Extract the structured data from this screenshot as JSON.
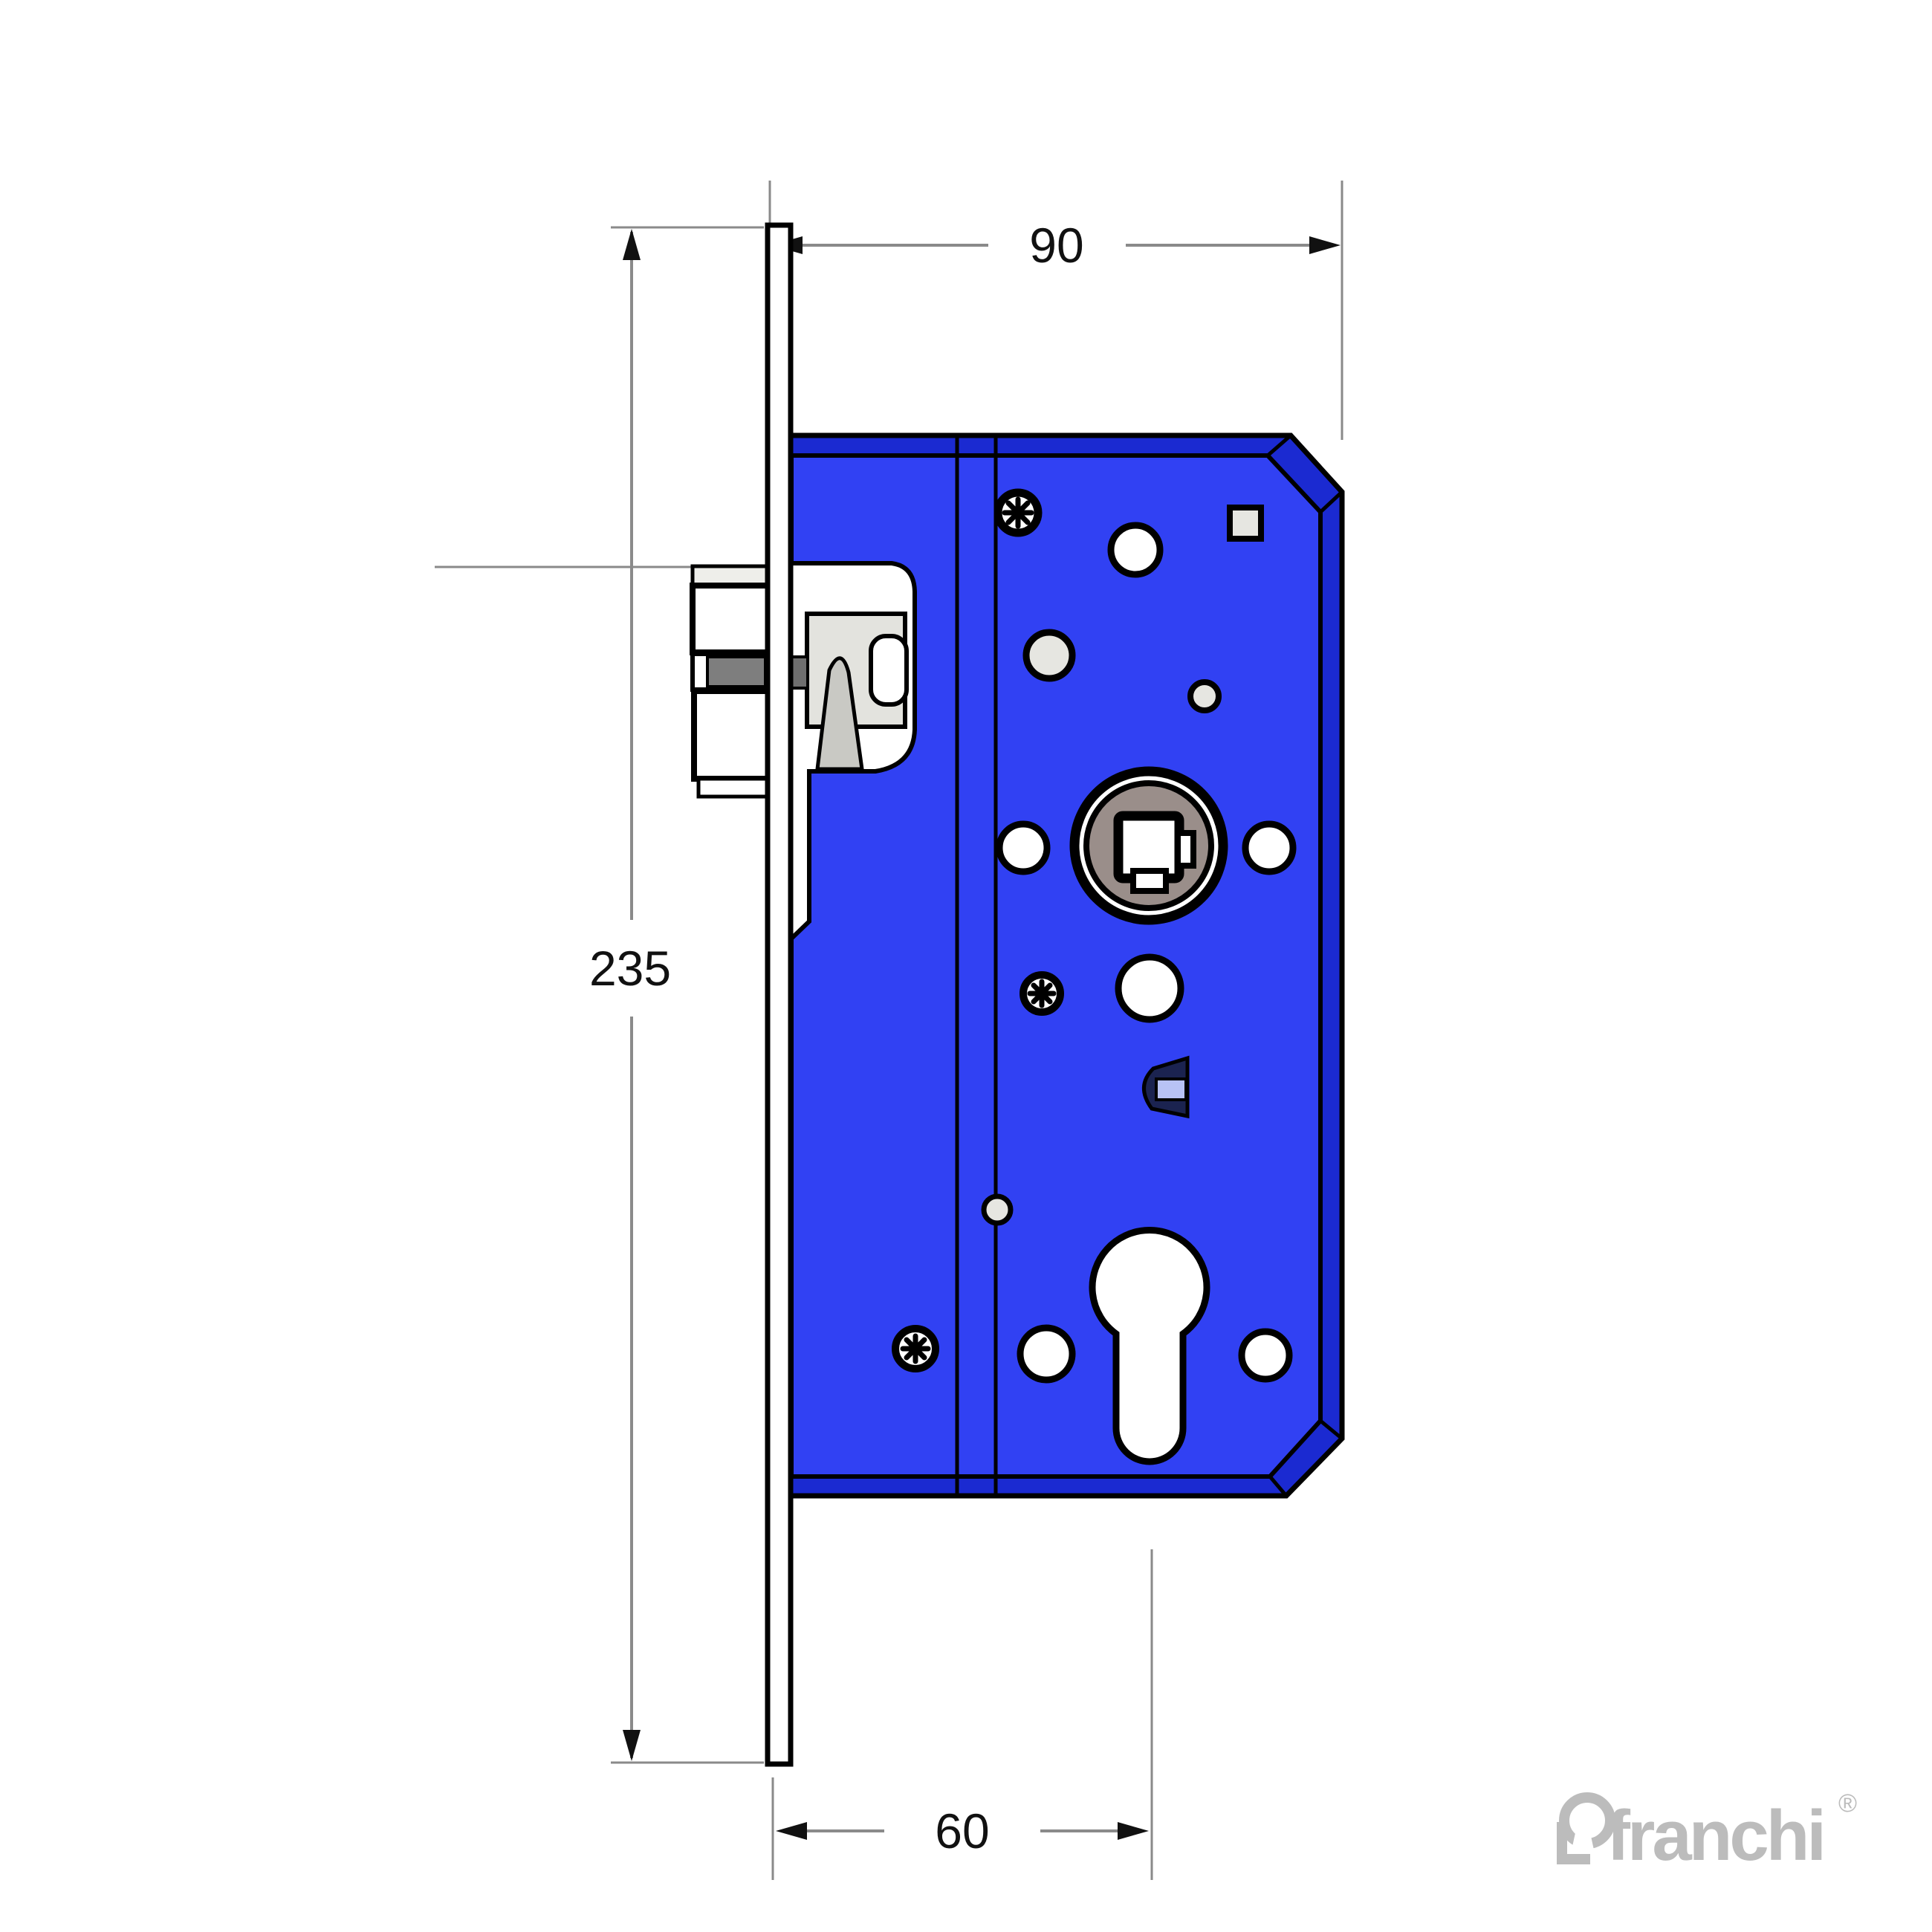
{
  "title": "mortise-lock-technical-drawing",
  "dims": {
    "width": "90",
    "height": "235",
    "backset": "60"
  },
  "logo": {
    "text": "franchi",
    "reg": "®"
  },
  "colors": {
    "body": "#3141f3",
    "body-dark": "#1b2ad1",
    "hole-gray": "#e6e6e1",
    "hub-gray": "#9a8e8a",
    "latch-gray": "#e3e3de",
    "wedge-gray": "#c9c9c4",
    "band-gray": "#7e7e7e",
    "behind-gray": "#6f6f6f",
    "dim-line": "#8a8a8a",
    "logo-gray": "#bcbcbc",
    "dpart-navy": "#1b2350",
    "dpart-light": "#b8c2f5"
  }
}
